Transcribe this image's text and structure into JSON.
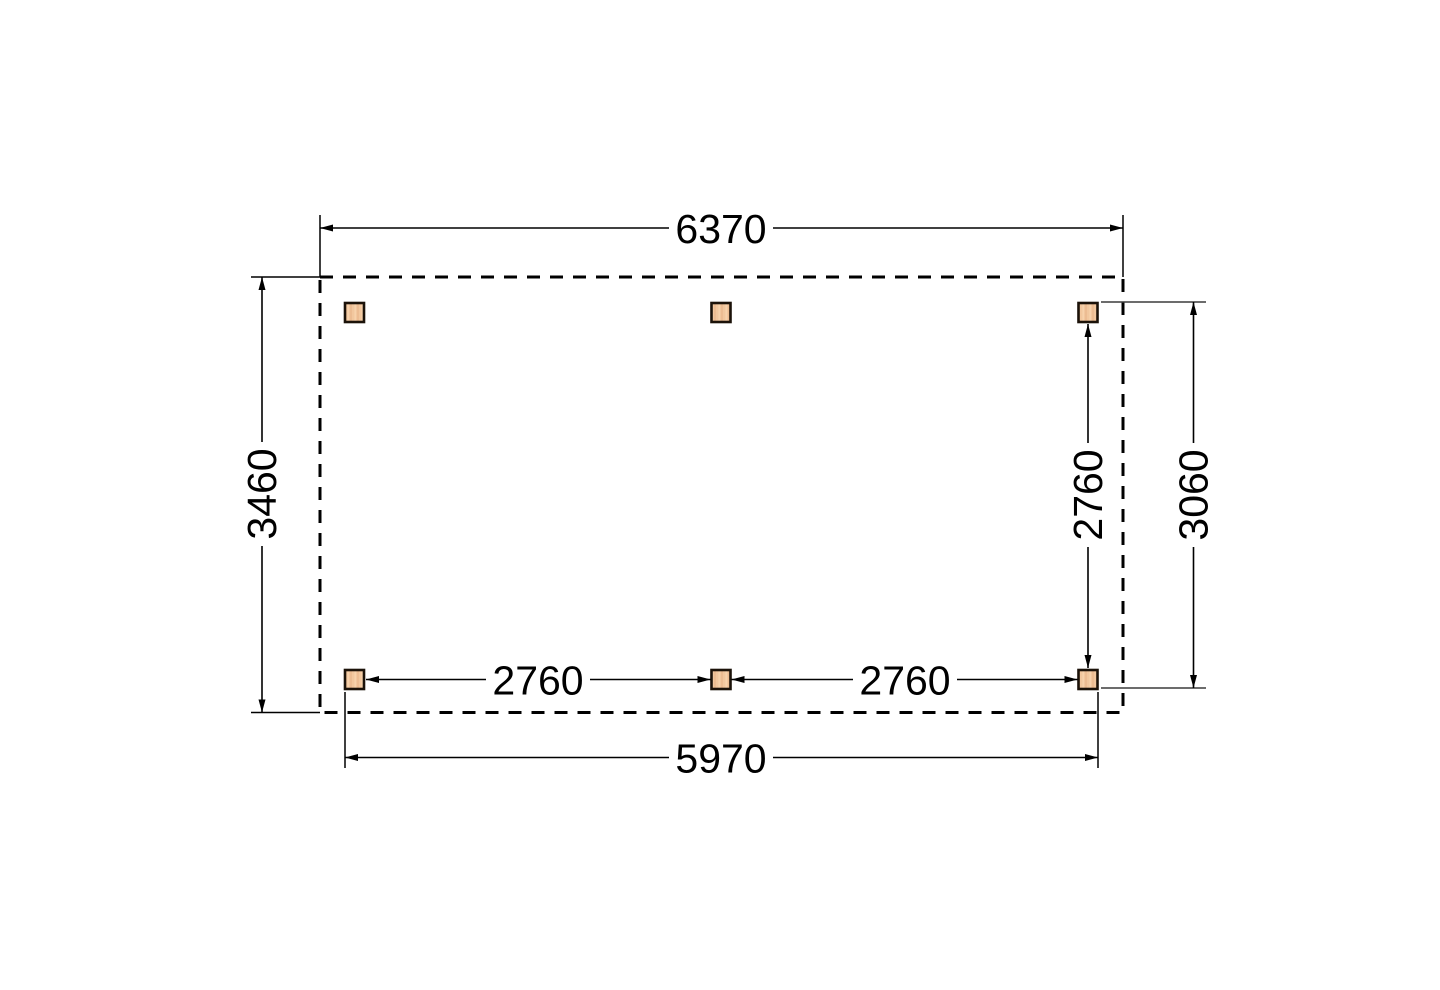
{
  "diagram": {
    "type": "floor-plan-top-view",
    "labels": {
      "total_width": "6370",
      "total_depth": "3460",
      "bay_left": "2760",
      "bay_right": "2760",
      "post_depth_spacing": "2760",
      "outer_depth": "3060",
      "post_span_width": "5970"
    },
    "colors": {
      "line": "#000000",
      "background": "#ffffff",
      "post_fill": "#f2c79e",
      "post_grain_dark": "#e5b285",
      "post_grain_light": "#fad7b2",
      "post_border": "#1b1209"
    },
    "posts": {
      "count": 6
    }
  }
}
